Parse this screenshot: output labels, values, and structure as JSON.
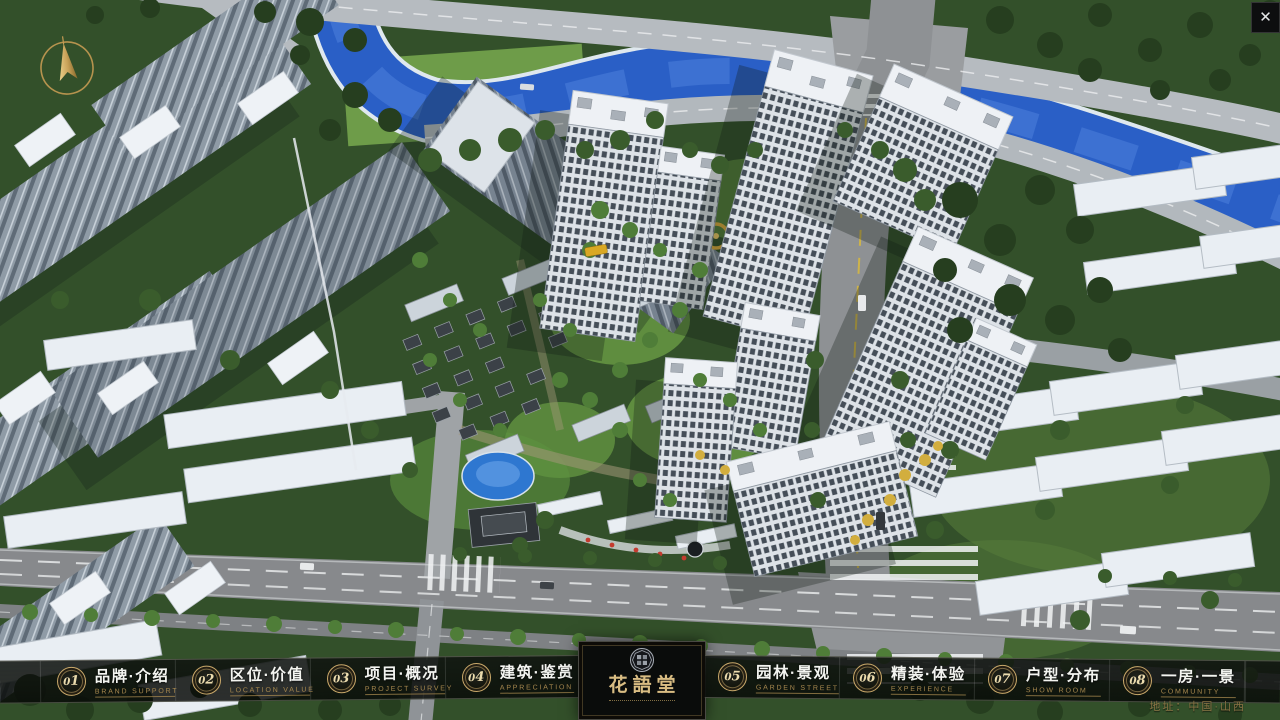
{
  "window": {
    "close_label": "✕"
  },
  "nav": {
    "items": [
      {
        "num": "01",
        "zh": "品牌·介绍",
        "en": "BRAND SUPPORT"
      },
      {
        "num": "02",
        "zh": "区位·价值",
        "en": "LOCATION VALUE"
      },
      {
        "num": "03",
        "zh": "项目·概况",
        "en": "PROJECT SURVEY"
      },
      {
        "num": "04",
        "zh": "建筑·鉴赏",
        "en": "APPRECIATION"
      },
      {
        "num": "05",
        "zh": "园林·景观",
        "en": "GARDEN STREET"
      },
      {
        "num": "06",
        "zh": "精装·体验",
        "en": "EXPERIENCE"
      },
      {
        "num": "07",
        "zh": "户型·分布",
        "en": "SHOW ROOM"
      },
      {
        "num": "08",
        "zh": "一房·一景",
        "en": "COMMUNITY"
      }
    ],
    "logo": {
      "title": "花語堂"
    }
  },
  "footer": {
    "address": "地址：中国·山西"
  },
  "colors": {
    "gold": "#c9a86a",
    "bar_bg": "rgba(12,16,13,0.85)",
    "river": "#2a5fc6",
    "sub_text": "#a8894f"
  }
}
